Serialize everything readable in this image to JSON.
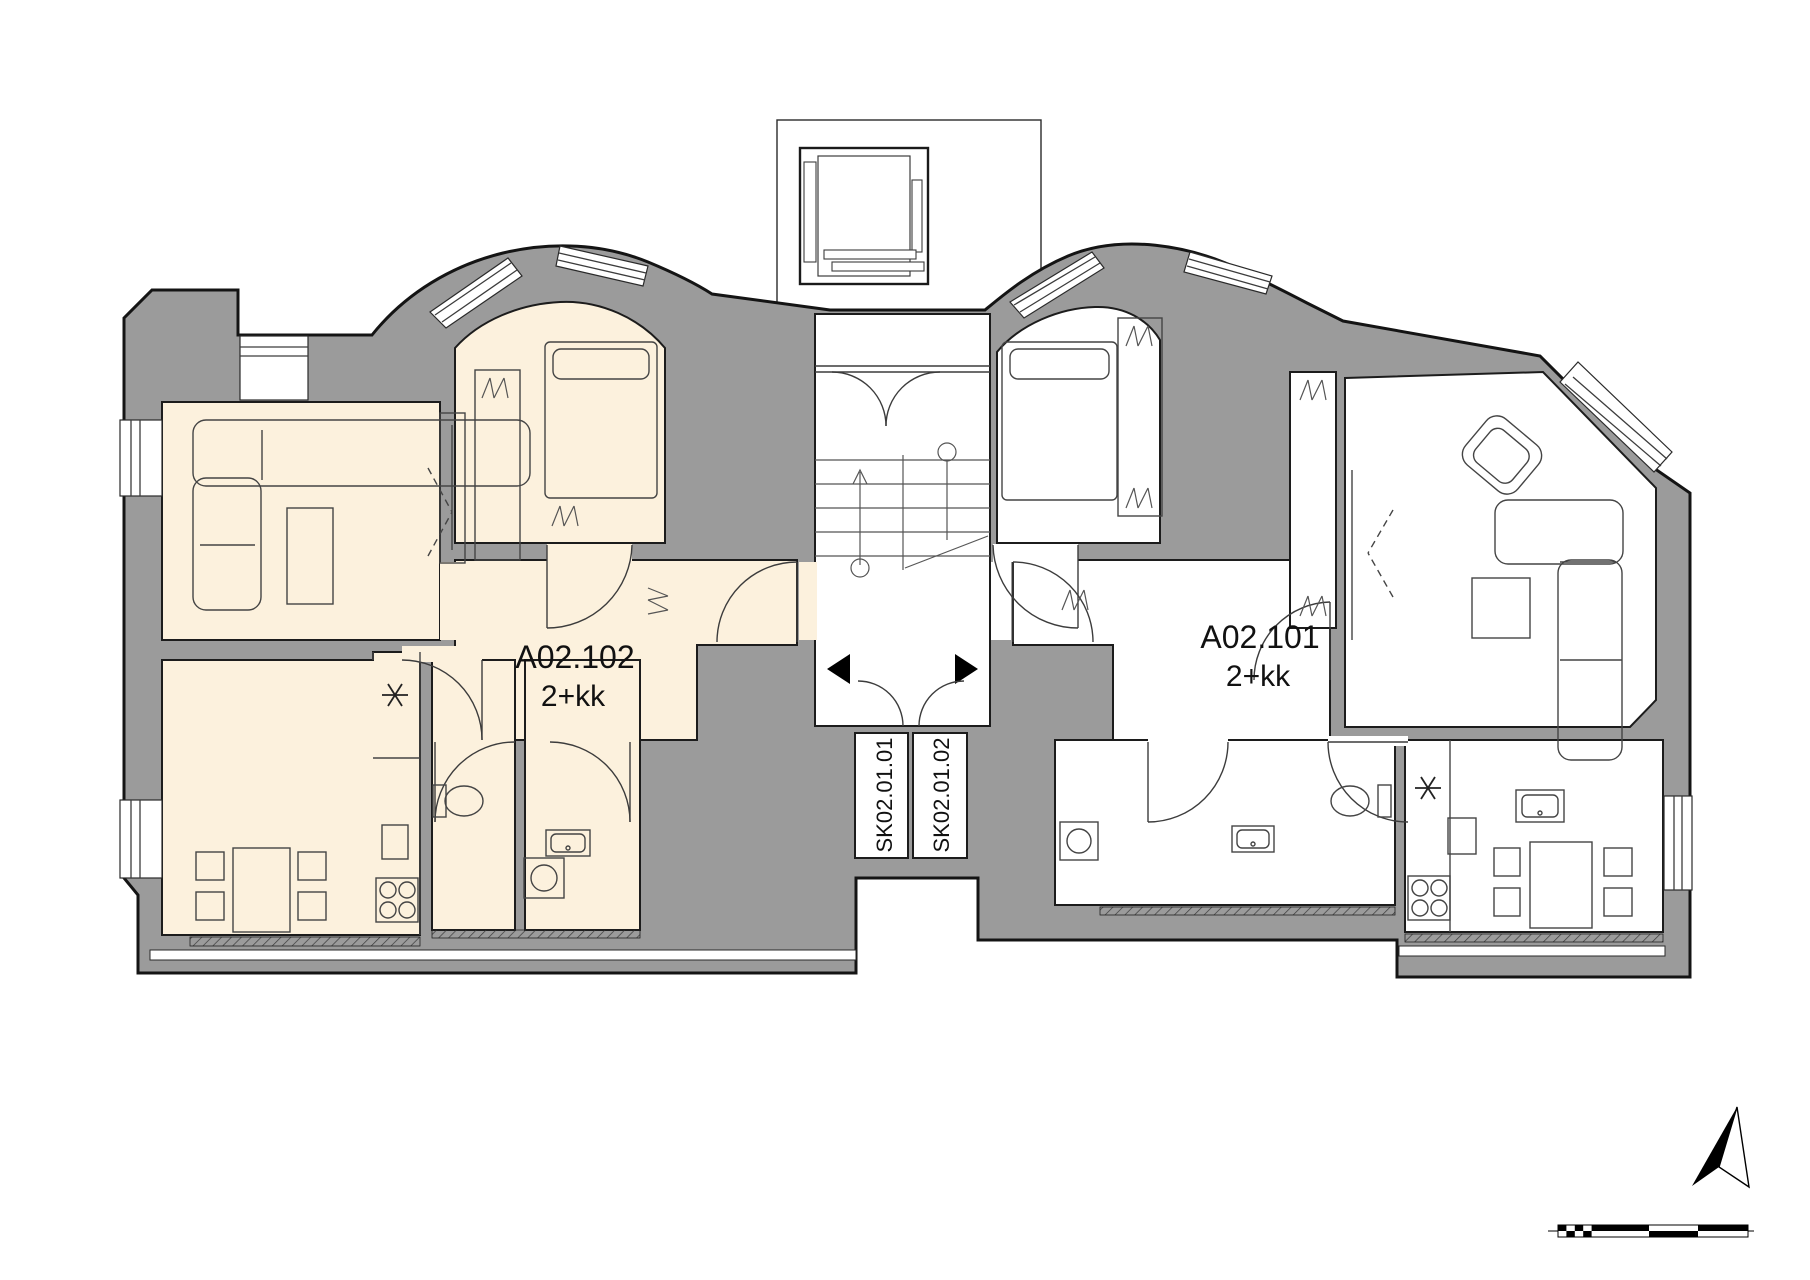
{
  "plan_type": "apartment-floor-plan",
  "units": [
    {
      "id": "A02.102",
      "layout": "2+kk",
      "highlighted": true
    },
    {
      "id": "A02.101",
      "layout": "2+kk",
      "highlighted": false
    }
  ],
  "storage_rooms": [
    {
      "id": "SK02.01.01"
    },
    {
      "id": "SK02.01.02"
    }
  ],
  "colors": {
    "wall_fill": "#9b9b9b",
    "outline": "#141414",
    "unit_a02_102_fill": "#fcf1dd",
    "unit_a02_101_fill": "#ffffff",
    "hatch_line": "#3a3a3a"
  },
  "symbols": {
    "north_arrow": "north-arrow",
    "scale_bar": "graphic-scale-bar",
    "utility_point_star": "six-spoke-star",
    "entrance_arrow_left_unit": "black-triangle-left",
    "entrance_arrow_right_unit": "black-triangle-right",
    "stairs_direction": "up-arrow"
  }
}
